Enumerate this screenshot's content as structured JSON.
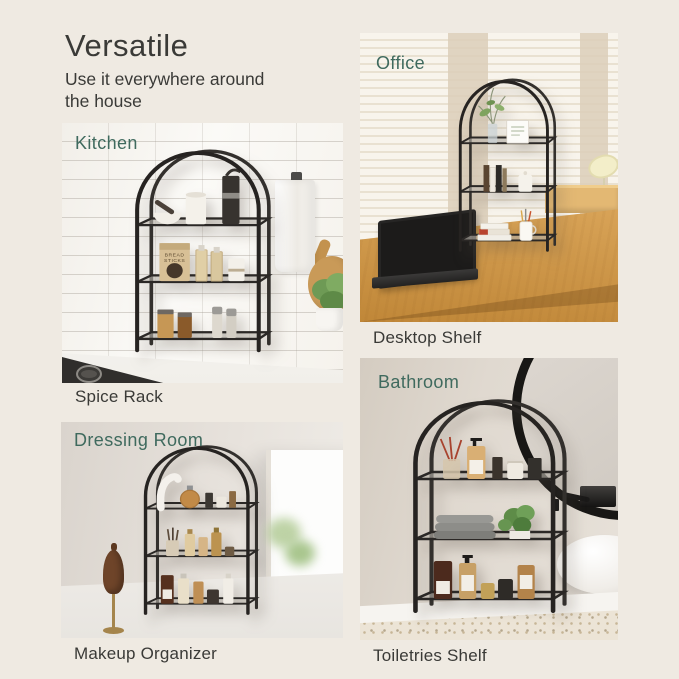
{
  "header": {
    "title": "Versatile",
    "subtitle": "Use it everywhere around the house"
  },
  "theme": {
    "background": "#EFEAE2",
    "text_color": "#3A3A37",
    "room_label_color": "#3F6A5E",
    "shelf_frame_color": "#262321"
  },
  "photos": {
    "kitchen": {
      "room_label": "Kitchen",
      "caption": "Spice Rack",
      "bag_text_line1": "BREAD",
      "bag_text_line2": "STICKS"
    },
    "office": {
      "room_label": "Office",
      "caption": "Desktop Shelf"
    },
    "dressing": {
      "room_label": "Dressing Room",
      "caption": "Makeup Organizer"
    },
    "bathroom": {
      "room_label": "Bathroom",
      "caption": "Toiletries Shelf"
    }
  }
}
